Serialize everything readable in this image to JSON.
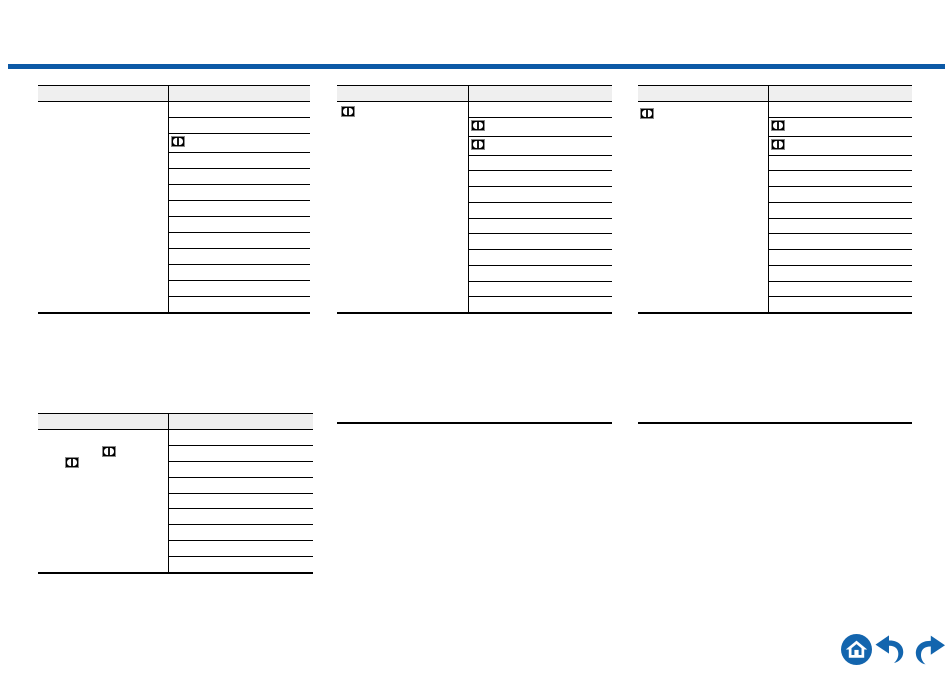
{
  "document": {
    "kind": "manual-page",
    "visible_text": "",
    "inline_icon": "dolby-digital-logo"
  },
  "colors": {
    "page_background": "#ffffff",
    "table_border": "#000000",
    "table_header_fill": "#efefef",
    "top_rule_blue": "#0c59a6",
    "nav_icon_blue": "#1365ae",
    "dolby_icon_black": "#000000",
    "dolby_icon_outline": "#8a8a8a"
  },
  "top_rule": {
    "left": 8,
    "top": 64,
    "width": 937,
    "height": 5
  },
  "tables": [
    {
      "name": "top-left",
      "left": 38,
      "top": 85,
      "width": 272,
      "split": 130,
      "header_height": 15,
      "body_height": 210,
      "row_count": 13,
      "left_cell_icons": [],
      "right_column_icon_rows": [
        3
      ]
    },
    {
      "name": "top-middle",
      "left": 337,
      "top": 85,
      "width": 275,
      "split": 131,
      "header_height": 15,
      "body_height": 210,
      "row_count": 13,
      "left_cell_icons": [
        {
          "left": 4,
          "top": 4
        }
      ],
      "right_column_icon_rows": [
        2,
        3
      ]
    },
    {
      "name": "top-right",
      "left": 638,
      "top": 85,
      "width": 274,
      "split": 130,
      "header_height": 15,
      "body_height": 210,
      "row_count": 13,
      "left_cell_icons": [
        {
          "left": 2,
          "top": 6
        }
      ],
      "right_column_icon_rows": [
        2,
        3
      ]
    },
    {
      "name": "bottom-left",
      "left": 38,
      "top": 413,
      "width": 275,
      "split": 130,
      "header_height": 15,
      "body_height": 142,
      "row_count": 9,
      "left_cell_icons": [
        {
          "left": 64,
          "top": 16
        },
        {
          "left": 27,
          "top": 27
        }
      ],
      "right_column_icon_rows": []
    }
  ],
  "separators": [
    {
      "left": 337,
      "top": 422,
      "width": 275
    },
    {
      "left": 638,
      "top": 422,
      "width": 274
    }
  ],
  "nav": {
    "buttons": [
      {
        "icon": "home-icon"
      },
      {
        "icon": "previous-page-icon"
      },
      {
        "icon": "next-page-icon"
      }
    ]
  }
}
